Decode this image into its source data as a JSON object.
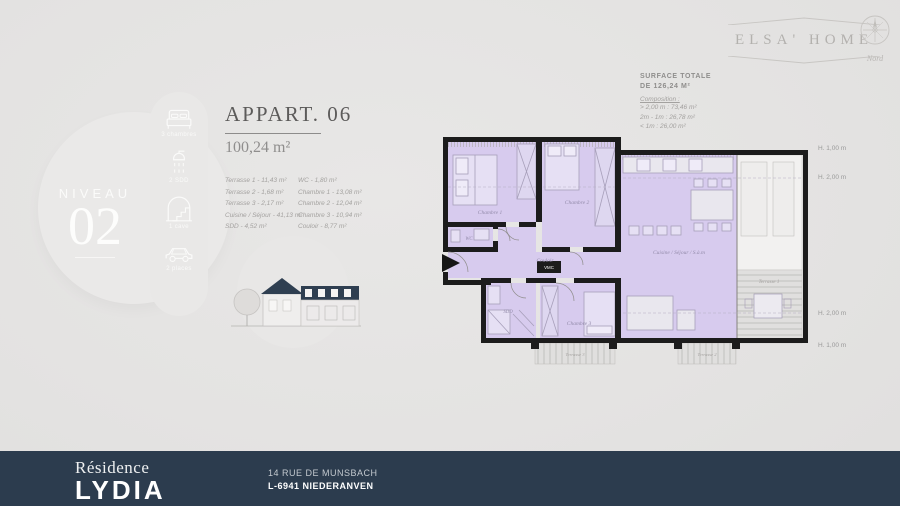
{
  "header": {
    "brand": "ELSA' HOME",
    "compass_label": "Nord"
  },
  "level": {
    "label": "NIVEAU",
    "number": "02"
  },
  "amenities": [
    {
      "icon": "bed-icon",
      "label": "3 chambres"
    },
    {
      "icon": "shower-icon",
      "label": "2 SDD"
    },
    {
      "icon": "cellar-icon",
      "label": "1 cave"
    },
    {
      "icon": "car-icon",
      "label": "2 places"
    }
  ],
  "apartment": {
    "title": "APPART. 06",
    "area": "100,24 m²",
    "rooms_col1": [
      "Terrasse 1 - 11,43 m²",
      "Terrasse 2 - 1,68 m²",
      "Terrasse 3 - 2,17 m²",
      "Cuisine / Séjour - 41,13 m²",
      "SDD - 4,52 m²"
    ],
    "rooms_col2": [
      "WC - 1,80 m²",
      "Chambre 1 - 13,08 m²",
      "Chambre 2 - 12,04 m²",
      "Chambre 3 - 10,94 m²",
      "Couloir - 8,77 m²"
    ]
  },
  "surface": {
    "title_line1": "SURFACE TOTALE",
    "title_line2": "DE 126,24 M²",
    "composition_label": "Composition :",
    "items": [
      "> 2,00 m : 73,46 m²",
      "2m - 1m : 26,78 m²",
      "< 1m : 26,00 m²"
    ]
  },
  "floorplan": {
    "rooms": {
      "chambre1": "Chambre 1",
      "chambre2": "Chambre 2",
      "chambre3": "Chambre 3",
      "wc": "WC",
      "sdd": "SDD",
      "couloir": "Couloir",
      "vmc": "VMC",
      "cuisine": "Cuisine / Séjour / S.à.m",
      "terrasse1": "Terrasse 1",
      "terrasse2": "Terrasse 2",
      "terrasse3": "Terrasse 3"
    },
    "heights": [
      "H. 1,00 m",
      "H. 2,00 m",
      "H. 2,00 m",
      "H. 1,00 m"
    ]
  },
  "footer": {
    "residence": "Résidence",
    "name": "LYDIA",
    "address_line1": "14 RUE DE MUNSBACH",
    "address_line2": "L-6941 NIEDERANVEN"
  },
  "colors": {
    "floor_accent": "#d7cbee",
    "wall": "#1c1c1c",
    "footer_bg": "#2c3c4e",
    "background": "#e4e3e2"
  }
}
